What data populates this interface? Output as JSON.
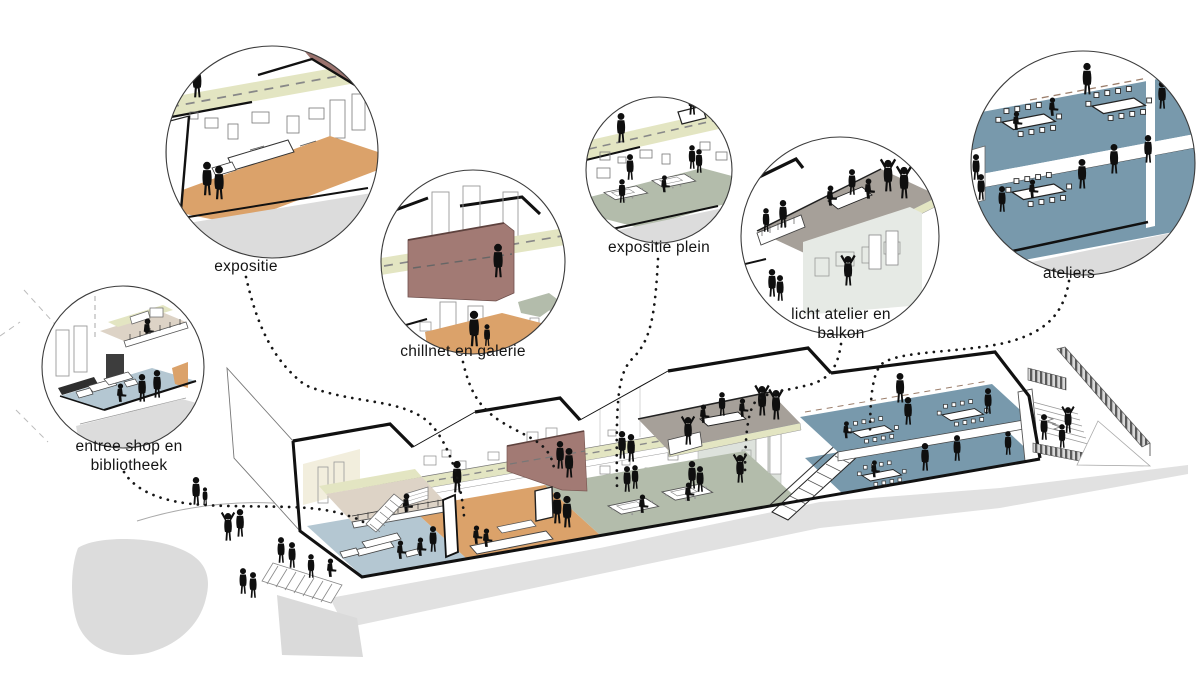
{
  "diagram": {
    "type": "architectural axonometric cutaway with detail callouts",
    "language": "nl"
  },
  "callouts": [
    {
      "id": "expositie",
      "label": "expositie"
    },
    {
      "id": "chillnet-en-galerie",
      "label": "chillnet en galerie"
    },
    {
      "id": "expositie-plein",
      "label": "expositie plein"
    },
    {
      "id": "licht-atelier-en-balkon",
      "label": "licht atelier en balkon"
    },
    {
      "id": "ateliers",
      "label": "ateliers"
    },
    {
      "id": "entree-shop-en-bibliotheek",
      "label": "entree shop en bibliotheek"
    }
  ],
  "colors": {
    "walkway_olive": "#e3e5c2",
    "expositie_orange": "#dba26a",
    "galerie_mauve": "#a27a74",
    "plein_sage": "#b3bcab",
    "ateliers_blue": "#7899ac",
    "entree_blue": "#b4c7d2",
    "terrace_taupe": "#a6a099",
    "mezzanine_tan": "#ddd3c6",
    "ground_gray": "#dcdcdc",
    "line_black": "#111111"
  }
}
